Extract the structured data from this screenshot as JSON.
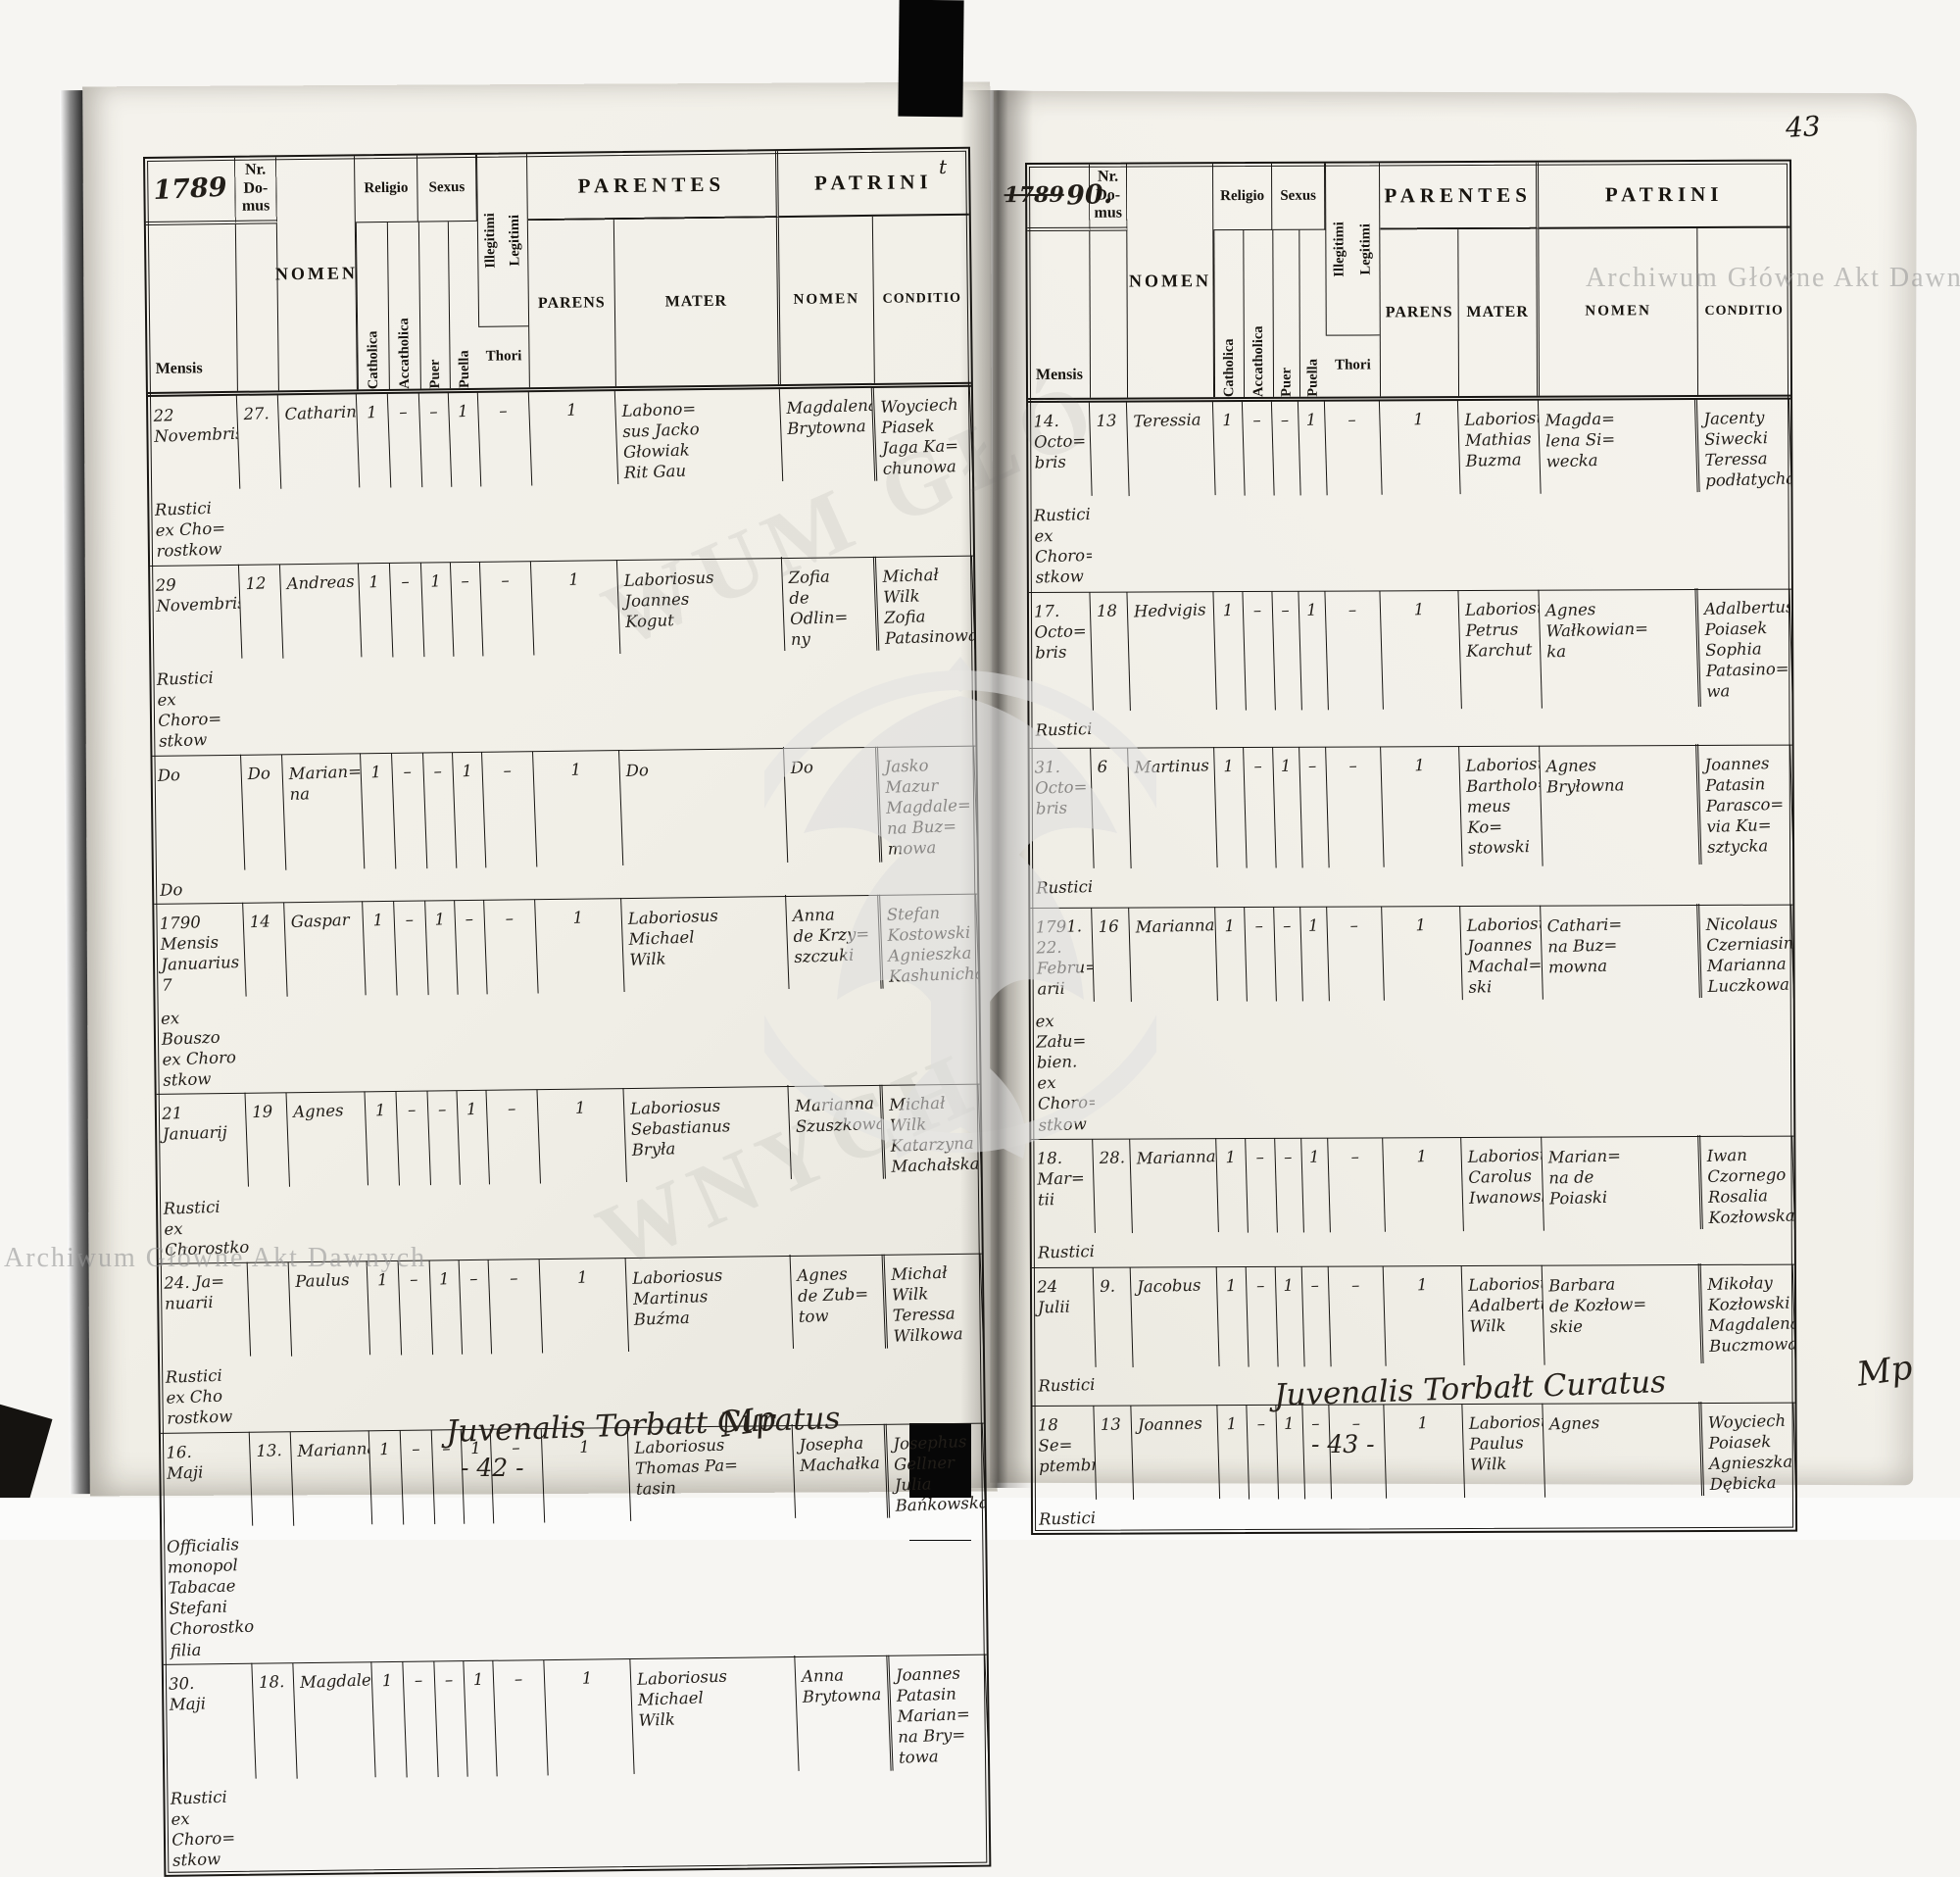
{
  "scan": {
    "corner_page_number": "43",
    "watermark_text": "Archiwum Główne Akt Dawnych",
    "watermark_ghost_upper": "WUM GŁÓ",
    "watermark_ghost_lower": "WNYCH",
    "stray_mark": "t",
    "ink_color": "#221e19",
    "paper_color": "#f2f0e9"
  },
  "headers": {
    "nr_domus": "Nr.\nDo-\nmus",
    "mensis": "Mensis",
    "nomen": "NOMEN",
    "religio": "Religio",
    "catholica": "Catholica",
    "accatholica": "Accatholica",
    "sexus": "Sexus",
    "puer": "Puer",
    "puella": "Puella",
    "illegitimi": "Illegitimi",
    "legitimi": "Legitimi",
    "thori": "Thori",
    "parentes": "PARENTES",
    "parens": "PARENS",
    "mater": "MATER",
    "patrini": "PATRINI",
    "patrini_nomen": "NOMEN",
    "conditio": "CONDITIO"
  },
  "left_page": {
    "year": "1789",
    "signature": "Juvenalis Torbatt Curatus",
    "signature_flourish": "Mp",
    "footer_page_number": "- 42 -",
    "rows": [
      {
        "mensis": "22\nNovembris",
        "nr": "27.",
        "nomen": "Catharina",
        "marks": [
          "1",
          "–",
          "–",
          "1",
          "–",
          "1"
        ],
        "parens": "Labono=\nsus Jacko\nGłowiak\nRit Gau",
        "mater": "Magdalena\nBrytowna",
        "pnomen": "Woyciech\nPiasek\nJaga Ka=\nchunowa",
        "cond": "Rustici\nex Cho=\nrostkow"
      },
      {
        "mensis": "29\nNovembris",
        "nr": "12",
        "nomen": "Andreas",
        "marks": [
          "1",
          "–",
          "1",
          "–",
          "–",
          "1"
        ],
        "parens": "Laboriosus\nJoannes\nKogut",
        "mater": "Zofia\nde Odlin=\nny",
        "pnomen": "Michał\nWilk\nZofia\nPatasinowa",
        "cond": "Rustici\nex Choro=\nstkow"
      },
      {
        "mensis": "Do",
        "nr": "Do",
        "nomen": "Marian=\nna",
        "marks": [
          "1",
          "–",
          "–",
          "1",
          "–",
          "1"
        ],
        "parens": "Do",
        "mater": "Do",
        "pnomen": "Jasko\nMazur\nMagdale=\nna Buz=\nmowa",
        "cond": "Do"
      },
      {
        "mensis": "1790\nMensis\nJanuarius\n7",
        "nr": "14",
        "nomen": "Gaspar",
        "marks": [
          "1",
          "–",
          "1",
          "–",
          "–",
          "1"
        ],
        "parens": "Laboriosus\nMichael\nWilk",
        "mater": "Anna\nde Krzy=\nszczuki",
        "pnomen": "Stefan\nKostowski\nAgnieszka\nKashunicha",
        "cond": "ex Bouszo\nex Choro\nstkow"
      },
      {
        "mensis": "21\nJanuarij",
        "nr": "19",
        "nomen": "Agnes",
        "marks": [
          "1",
          "–",
          "–",
          "1",
          "–",
          "1"
        ],
        "parens": "Laboriosus\nSebastianus\nBryła",
        "mater": "Marianna\nSzuszkowa",
        "pnomen": "Michał\nWilk\nKatarzyna\nMachałska",
        "cond": "Rustici\nex\nChorostkow"
      },
      {
        "mensis": "24. Ja=\nnuarii",
        "nr": "",
        "nomen": "Paulus",
        "marks": [
          "1",
          "–",
          "1",
          "–",
          "–",
          "1"
        ],
        "parens": "Laboriosus\nMartinus\nBuźma",
        "mater": "Agnes\nde Zub=\ntow",
        "pnomen": "Michał\nWilk\nTeressa\nWilkowa",
        "cond": "Rustici\nex Cho\nrostkow"
      },
      {
        "mensis": "16.\nMaji",
        "nr": "13.",
        "nomen": "Marianna",
        "marks": [
          "1",
          "–",
          "–",
          "1",
          "–",
          "1"
        ],
        "parens": "Laboriosus\nThomas Pa=\ntasin",
        "mater": "Josepha\nMachałka",
        "pnomen": "Josephus\nGellner\nJulia\nBańkowska",
        "cond": "Officialis\nmonopol\nTabacae\nStefani\nChorostkow\nfilia"
      },
      {
        "mensis": "30.\nMaji",
        "nr": "18.",
        "nomen": "Magdalena",
        "marks": [
          "1",
          "–",
          "–",
          "1",
          "–",
          "1"
        ],
        "parens": "Laboriosus\nMichael\nWilk",
        "mater": "Anna\nBrytowna",
        "pnomen": "Joannes\nPatasin\nMarian=\nna Bry=\ntowa",
        "cond": "Rustici\nex Choro=\nstkow"
      }
    ]
  },
  "right_page": {
    "year_old": "1789",
    "year_new": "90.",
    "signature": "Juvenalis Torbałt Curatus",
    "signature_flourish": "Mp",
    "footer_page_number": "- 43 -",
    "rows": [
      {
        "mensis": "14. Octo=\nbris",
        "nr": "13",
        "nomen": "Teressia",
        "marks": [
          "1",
          "–",
          "–",
          "1",
          "–",
          "1"
        ],
        "parens": "Laboriosus\nMathias\nBuzma",
        "mater": "Magda=\nlena Si=\nwecka",
        "pnomen": "Jacenty\nSiwecki\nTeressa\npodłatycha",
        "cond": "Rustici\nex Choro=\nstkow"
      },
      {
        "mensis": "17. Octo=\nbris",
        "nr": "18",
        "nomen": "Hedvigis",
        "marks": [
          "1",
          "–",
          "–",
          "1",
          "–",
          "1"
        ],
        "parens": "Laboriosus\nPetrus\nKarchut",
        "mater": "Agnes\nWałkowian=\nka",
        "pnomen": "Adalbertus\nPoiasek\nSophia\nPatasino=\nwa",
        "cond": "Rustici"
      },
      {
        "mensis": "31. Octo=\nbris",
        "nr": "6",
        "nomen": "Martinus",
        "marks": [
          "1",
          "–",
          "1",
          "–",
          "–",
          "1"
        ],
        "parens": "Laboriosus\nBartholo=\nmeus Ko=\nstowski",
        "mater": "Agnes\nBryłowna",
        "pnomen": "Joannes\nPatasin\nParasco=\nvia Ku=\nsztycka",
        "cond": "Rustici"
      },
      {
        "mensis": "1791.\n22. Febru=\narii",
        "nr": "16",
        "nomen": "Marianna",
        "marks": [
          "1",
          "–",
          "–",
          "1",
          "–",
          "1"
        ],
        "parens": "Laboriosus\nJoannes\nMachal=\nski",
        "mater": "Cathari=\nna Buz=\nmowna",
        "pnomen": "Nicolaus\nCzerniasin\nMarianna\nLuczkowa",
        "cond": "ex Zału=\nbien.\nex Choro=\nstkow"
      },
      {
        "mensis": "18. Mar=\ntii",
        "nr": "28.",
        "nomen": "Marianna",
        "marks": [
          "1",
          "–",
          "–",
          "1",
          "–",
          "1"
        ],
        "parens": "Laboriosus\nCarolus\nIwanowski",
        "mater": "Marian=\nna de\nPoiaski",
        "pnomen": "Iwan\nCzornego\nRosalia\nKozłowska",
        "cond": "Rustici"
      },
      {
        "mensis": "24 Julii",
        "nr": "9.",
        "nomen": "Jacobus",
        "marks": [
          "1",
          "–",
          "1",
          "–",
          "–",
          "1"
        ],
        "parens": "Laboriosus\nAdalbertus\nWilk",
        "mater": "Barbara\nde Kozłow=\nskie",
        "pnomen": "Mikołay\nKozłowski\nMagdalena\nBuczmowa",
        "cond": "Rustici"
      },
      {
        "mensis": "18 Se=\nptembris",
        "nr": "13",
        "nomen": "Joannes",
        "marks": [
          "1",
          "–",
          "1",
          "–",
          "–",
          "1"
        ],
        "parens": "Laboriosus\nPaulus\nWilk",
        "mater": "Agnes",
        "pnomen": "Woyciech\nPoiasek\nAgnieszka\nDębicka",
        "cond": "Rustici"
      }
    ]
  }
}
